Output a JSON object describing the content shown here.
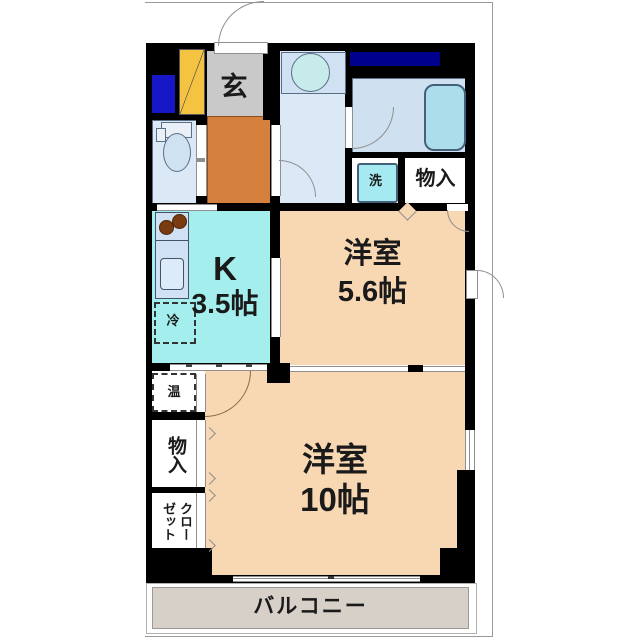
{
  "floorplan": {
    "type": "apartment-floor-plan",
    "labels": {
      "genkan": "玄",
      "laundry": "洗",
      "storage_top": "物入",
      "kitchen_k": "K",
      "kitchen_size": "3.5帖",
      "fridge": "冷",
      "room1_name": "洋室",
      "room1_size": "5.6帖",
      "heater": "温",
      "storage_left": "物入",
      "closet": "クローゼット",
      "room2_name": "洋室",
      "room2_size": "10帖",
      "balcony": "バルコニー"
    },
    "colors": {
      "wall": "#000000",
      "room_peach": "#f8d7b3",
      "kitchen_cyan": "#a4efee",
      "corridor_orange": "#d5803c",
      "genkan_gray": "#c9c9c9",
      "wet_area_blue": "#dbe9f6",
      "bath_blue": "#cfe0f0",
      "tub_fill": "#abdeea",
      "laundry_pan": "#a5eaf0",
      "pipe_navy": "#00008f",
      "pipe_blue": "#1616c6",
      "shoebox_yellow": "#f5c342",
      "balcony_gray": "#d6d0c9"
    }
  }
}
